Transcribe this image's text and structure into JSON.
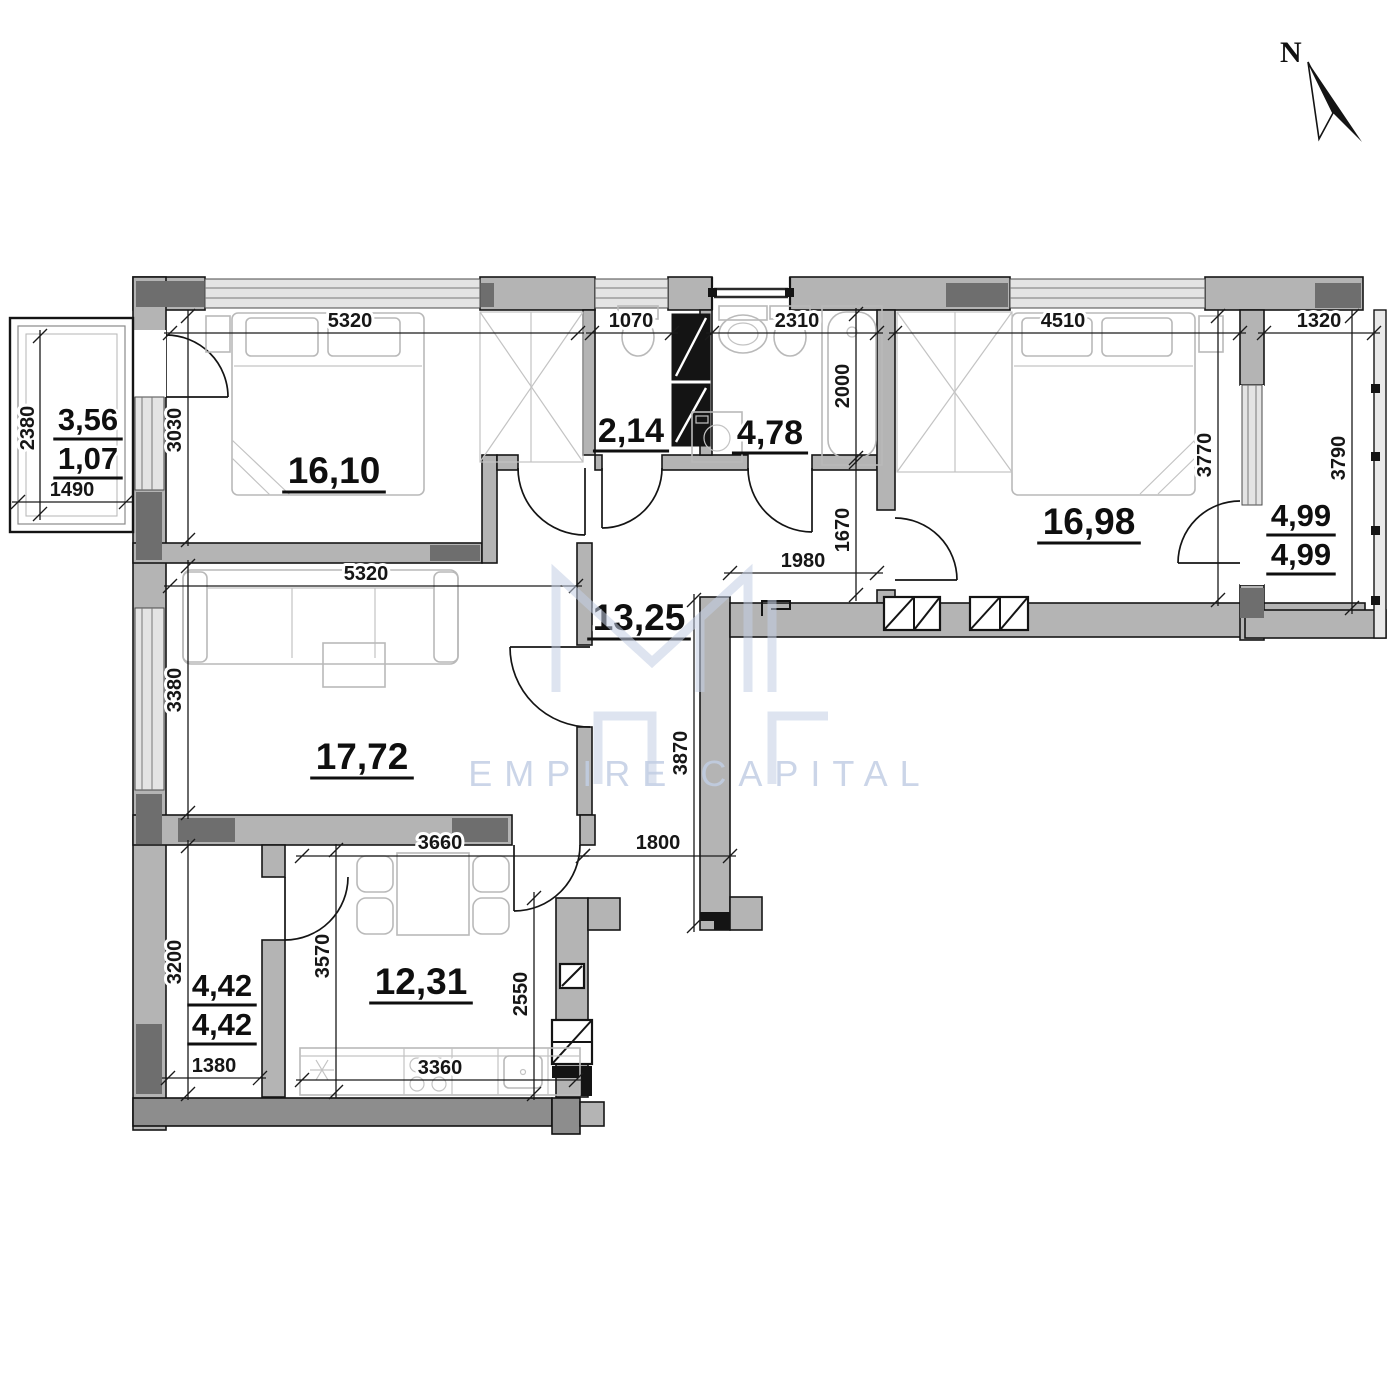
{
  "compass": {
    "north_label": "N"
  },
  "watermark": {
    "text": "EMPIRE CAPITAL"
  },
  "rooms": {
    "bedroom1": {
      "area": "16,10"
    },
    "wc": {
      "area": "2,14"
    },
    "bathroom": {
      "area": "4,78"
    },
    "bedroom2": {
      "area": "16,98"
    },
    "hallway": {
      "area": "13,25"
    },
    "living": {
      "area": "17,72"
    },
    "kitchen": {
      "area": "12,31"
    },
    "loggia_left": {
      "area_total": "3,56",
      "area_reduced": "1,07"
    },
    "loggia_bottom": {
      "area_total": "4,42",
      "area_reduced": "4,42"
    },
    "loggia_right": {
      "area_total": "4,99",
      "area_reduced": "4,99"
    }
  },
  "dimensions": {
    "bedroom1_width": "5320",
    "wc_width": "1070",
    "bathroom_width": "2310",
    "bedroom2_width": "4510",
    "loggia_right_width": "1320",
    "loggia_left_height": "2380",
    "loggia_left_width": "1490",
    "bedroom1_height": "3030",
    "bathtub_length": "2000",
    "hall_niche_height": "1670",
    "bedroom2_height": "3770",
    "loggia_right_height": "3790",
    "hall_width_top": "1980",
    "living_width": "5320",
    "living_height": "3380",
    "hall_height": "3870",
    "kitchen_width": "3660",
    "hall_bottom_width": "1800",
    "loggia_bottom_height": "3200",
    "kitchen_height": "3570",
    "kitchen_right_height": "2550",
    "loggia_bottom_width": "1380",
    "counter_width": "3360"
  }
}
